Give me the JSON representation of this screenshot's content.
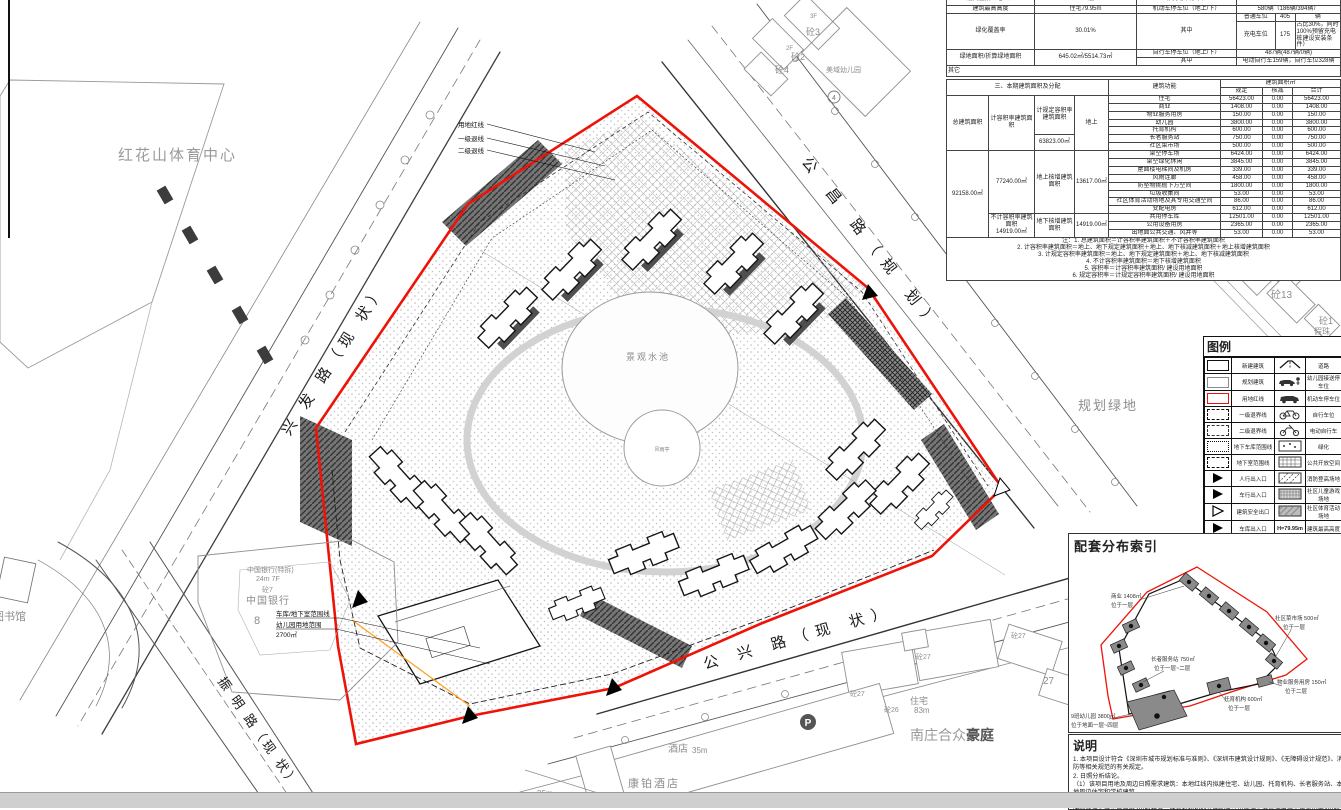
{
  "colors": {
    "red_line": "#ee1308",
    "new_building": "#161616",
    "existing": "#8f8f8f"
  },
  "tables": {
    "info": {
      "cut": [
        "最大层数（地上）",
        "23/7层",
        "非机动车停车位",
        "—"
      ],
      "r1": [
        "建筑最高高度",
        "住宅79.95m",
        "机动车停车位（地上/下）",
        "580辆（186辆/394辆）"
      ],
      "r2": [
        "绿化覆盖率",
        "30.01%",
        "其中"
      ],
      "r2sub": [
        [
          "普通车位",
          "405",
          "辆"
        ],
        [
          "充电车位",
          "175",
          "占比30%，同时100%预留充电桩建设安装条件）"
        ]
      ],
      "r3": [
        "绿地面积/折算绿地面积",
        "645.02㎡/5514.73㎡"
      ],
      "r3sub": [
        [
          "自行车停车位（地上/下）",
          "487辆(487辆/0辆)"
        ],
        [
          "其中",
          "电动自行车159辆，自行车位328辆"
        ]
      ],
      "r4": "其它"
    },
    "area": {
      "title": "三、本期建筑面积及分配",
      "func_h": "建筑功能",
      "area_h": "建筑面积㎡",
      "sub_h": [
        "规定",
        "核减",
        "合计"
      ],
      "left": {
        "total_label": "总建筑面积",
        "total_value": "92158.00㎡",
        "far_label": "计容积率建筑面积",
        "far_value": "77240.00㎡",
        "nofar_label": "不计容积率建筑面积",
        "nofar_value": "14919.00㎡",
        "reg_label": "计规定容积率建筑面积",
        "reg_value": "63823.00㎡",
        "above_add_label": "地上核增建筑面积",
        "below_add_label": "地下核增建筑面积",
        "above": "地上",
        "above_add_value": "13617.00㎡",
        "below_add_value": "14919.00㎡"
      },
      "rows": [
        [
          "住宅",
          "56423.00",
          "0.00",
          "56423.00"
        ],
        [
          "商业",
          "1408.00",
          "0.00",
          "1408.00"
        ],
        [
          "物业服务用房",
          "150.00",
          "0.00",
          "150.00"
        ],
        [
          "幼儿园",
          "3800.00",
          "0.00",
          "3800.00"
        ],
        [
          "托育机构",
          "600.00",
          "0.00",
          "600.00"
        ],
        [
          "长者服务站",
          "750.00",
          "0.00",
          "750.00"
        ],
        [
          "社区菜市场",
          "500.00",
          "0.00",
          "500.00"
        ],
        [
          "架空停车场",
          "6424.00",
          "0.00",
          "6424.00"
        ],
        [
          "架空绿化休闲",
          "3845.00",
          "0.00",
          "3845.00"
        ],
        [
          "屋面楼电梯间及机房",
          "339.00",
          "0.00",
          "339.00"
        ],
        [
          "风雨连廊",
          "458.00",
          "0.00",
          "458.00"
        ],
        [
          "防坠物挑檐下方空间",
          "1800.00",
          "0.00",
          "1800.00"
        ],
        [
          "垃圾收集间",
          "53.00",
          "0.00",
          "53.00"
        ],
        [
          "社区体育活动场地及其专用交通空间",
          "86.00",
          "0.00",
          "86.00"
        ],
        [
          "变配电房",
          "612.00",
          "0.00",
          "612.00"
        ],
        [
          "共用停车库",
          "12501.00",
          "0.00",
          "12501.00"
        ],
        [
          "公用设备用房",
          "2365.00",
          "0.00",
          "2365.00"
        ],
        [
          "出地面公共交通、风井等",
          "53.00",
          "0.00",
          "53.00"
        ]
      ],
      "notes": [
        "注：1. 总建筑面积＝计容积率建筑面积＋不计容积率建筑面积",
        "2. 计容积率建筑面积＝地上、地下规定建筑面积＋地上、地下核减建筑面积＋地上核增建筑面积",
        "3. 计规定容积率建筑面积＝地上、地下规定建筑面积＋地上、地下核减建筑面积",
        "4. 不计容积率建筑面积＝地下核增建筑面积",
        "5. 容积率＝计容积率建筑面积/ 建设用地面积",
        "6. 规定容积率＝计规定容积率建筑面积/ 建设用地面积"
      ]
    }
  },
  "legend": {
    "title": "图例",
    "height_value": "H=79.95m",
    "rows": [
      {
        "l": "新建建筑",
        "r": "道路"
      },
      {
        "l": "规划建筑",
        "r": "幼儿园接送停车位"
      },
      {
        "l": "用地红线",
        "r": "机动车停车位"
      },
      {
        "l": "一级退界线",
        "r": "自行车位"
      },
      {
        "l": "二级退界线",
        "r": "电动自行车"
      },
      {
        "l": "地下车库范围线",
        "r": "绿化"
      },
      {
        "l": "地下室范围线",
        "r": "公共开放空间"
      },
      {
        "l": "人行出入口",
        "r": "消防登高场地"
      },
      {
        "l": "车行出入口",
        "r": "社区儿童游戏场地"
      },
      {
        "l": "建筑安全出口",
        "r": "社区体育活动场地"
      },
      {
        "l": "车库出入口",
        "r": "建筑最高高度"
      }
    ]
  },
  "inset": {
    "title": "配套分布索引",
    "labels": [
      {
        "a": "商业 1408㎡",
        "b": "位于一层"
      },
      {
        "a": "社区菜市场 500㎡",
        "b": "位于一层"
      },
      {
        "a": "长者服务站 750㎡",
        "b": "位于一层~二层"
      },
      {
        "a": "物业服务用房 150㎡",
        "b": "位于二层"
      },
      {
        "a": "托育机构 600㎡",
        "b": "位于一层"
      },
      {
        "a": "9班幼儿园 3800㎡",
        "b": "位于地面一层~四层"
      }
    ]
  },
  "notes": {
    "title": "说明",
    "lines": [
      "1. 本项目设计符合《深圳市城市规划标准与准则》、《深圳市建筑设计规则》、《无障碍设计规范》、消防等相关规范的有关规定。",
      "2. 日照分析结论。",
      "（1）该项目用地及周边日照需求建筑：本地红线内拟建住宅、幼儿园、托育机构、长者服务站、本地周边住宅和学校建筑。",
      "（2）通过日照分析，地块内每套住宅至少一间居室日照满足冬至日不低于1小时的日照标准，长者服务站满足冬至日日照2小时标准，托育机构和幼儿园的生活用房满足底层满窗冬至日不小于3小时的"
    ]
  },
  "plan": {
    "sports_center": "红花山体育中心",
    "library": "图书馆",
    "green_area": "规划绿地",
    "pond": "景观水池",
    "pavilion": "风雨亭",
    "p_mark": "P",
    "roads": {
      "xingfa": "兴 发 路（现 状）",
      "gongchang": "公 昌 路（规 划）",
      "gongxing": "公 兴 路（现 状）",
      "zhenming": "振 明 路（现 状）"
    },
    "boundary": {
      "red": "用地红线",
      "setback1": "一级退线",
      "setback2": "二级退线",
      "garage": "车库/地下室范围线",
      "kg_site": "幼儿园用地范围",
      "kg_area": "2700㎡"
    },
    "bank": {
      "l1": "中国银行(特拆)",
      "l2": "24m 7F",
      "l3": "砼7",
      "l4": "中国银行",
      "l5": "8"
    },
    "hotel": {
      "name": "酒店",
      "h": "35m",
      "name2": "康铂酒店",
      "h25": "25m",
      "h29": "29m"
    },
    "nanzhuang": {
      "p1": "南庄合众",
      "p2": "豪庭"
    },
    "resid": {
      "zhuzhai": "住宅",
      "h83": "83m",
      "t26": "砼26",
      "t27": "砼27",
      "n27": "27"
    },
    "north": {
      "f3": "3F",
      "t3": "砼3",
      "f2": "2F",
      "t2": "砼2",
      "t4": "砼4",
      "kg": "美域幼儿园",
      "c4": "4"
    },
    "east": {
      "t12": "砼12",
      "n14": "14",
      "t13": "砼13",
      "t1": "砼1",
      "jz": "假珠"
    }
  }
}
